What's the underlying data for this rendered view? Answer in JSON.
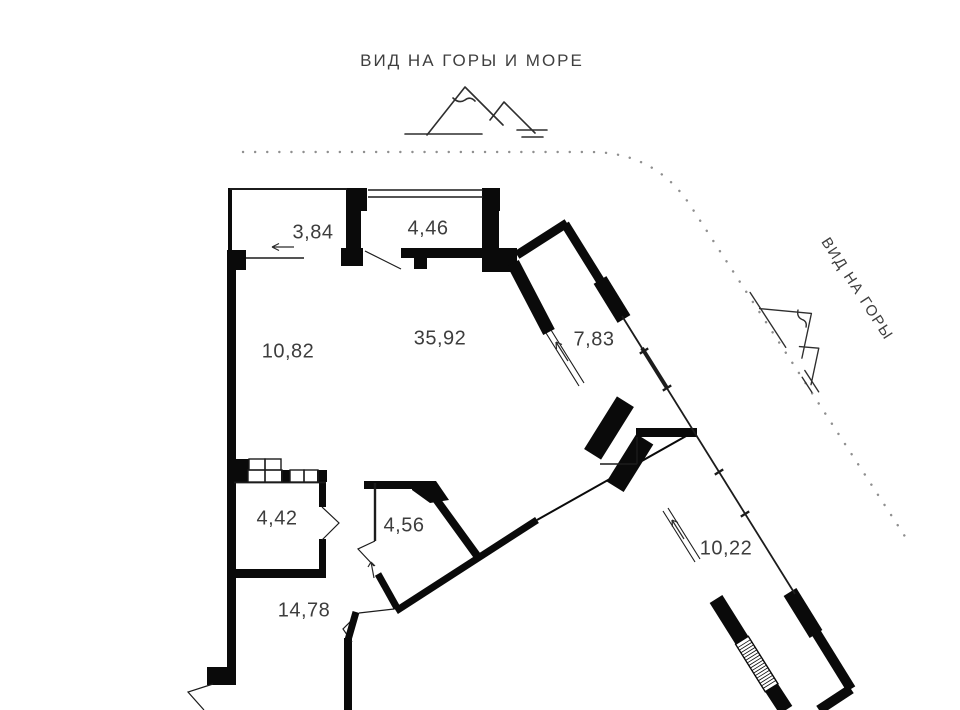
{
  "plan": {
    "captions": {
      "top": "ВИД НА ГОРЫ И МОРЕ",
      "side": "ВИД НА ГОРЫ"
    },
    "rooms": [
      {
        "area": "3,84"
      },
      {
        "area": "4,46"
      },
      {
        "area": "10,82"
      },
      {
        "area": "35,92"
      },
      {
        "area": "7,83"
      },
      {
        "area": "4,42"
      },
      {
        "area": "4,56"
      },
      {
        "area": "14,78"
      },
      {
        "area": "10,22"
      }
    ],
    "icons": {
      "top_icon": "mountains-icon",
      "side_icon": "mountains-icon"
    },
    "colors": {
      "wall": "#0a0a0a",
      "thin_line": "#1c1c1c",
      "label_text": "#3d3d3d",
      "dotted_boundary": "#8f8f8f",
      "background": "#ffffff"
    }
  }
}
